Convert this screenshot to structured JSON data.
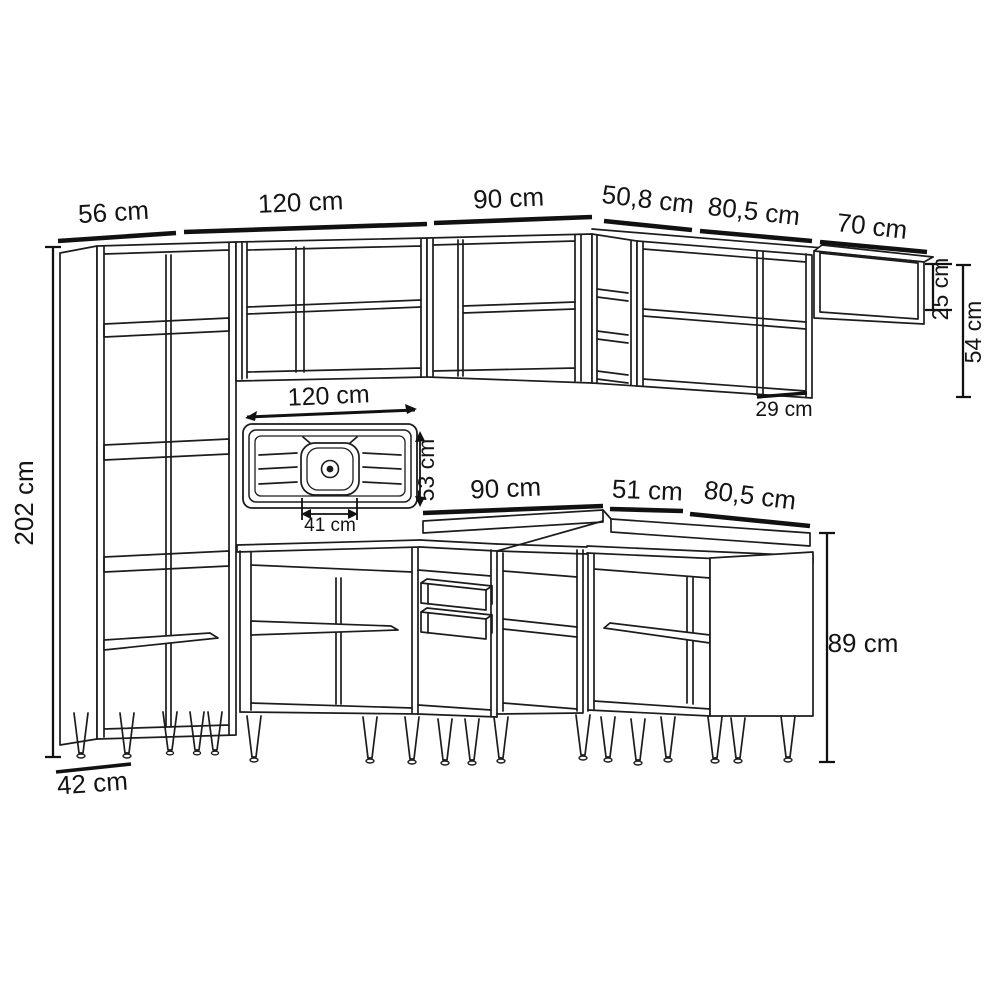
{
  "title": "Modular kitchen cabinet set dimensional line drawing",
  "colors": {
    "background": "#ffffff",
    "line": "#1c1c1c",
    "dimension": "#111111",
    "text": "#141414"
  },
  "units": "cm",
  "labels": {
    "tall_cabinet_width": "56 cm",
    "upper_cabinet_left_width": "120 cm",
    "upper_cabinet_mid_width": "90 cm",
    "upper_corner_cabinet_width": "50,8 cm",
    "upper_cabinet_right_width": "80,5 cm",
    "wall_shelf_width": "70 cm",
    "wall_shelf_height": "25 cm",
    "upper_section_height": "54 cm",
    "upper_cabinet_depth": "29 cm",
    "tall_cabinet_height": "202 cm",
    "tall_cabinet_depth": "42 cm",
    "sink_width": "120 cm",
    "sink_depth": "53 cm",
    "sink_bowl_width": "41 cm",
    "counter_left_width": "90 cm",
    "counter_corner_width": "51 cm",
    "base_cabinet_right_width": "80,5 cm",
    "base_cabinet_height": "89 cm"
  }
}
